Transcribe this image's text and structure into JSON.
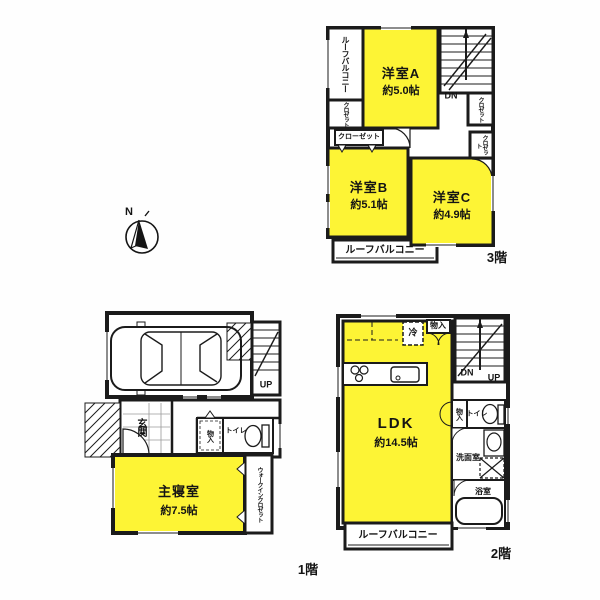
{
  "document": {
    "type": "floor-plan-scan",
    "compass_north": "N"
  },
  "colors": {
    "room_fill": "#fdf435",
    "wall": "#1b1b1b",
    "background": "#ffffff"
  },
  "floor1": {
    "label": "1階",
    "bedroom_name": "主寝室",
    "bedroom_size": "約7.5帖",
    "entrance": "玄関",
    "storage": "物入",
    "toilet": "トイレ",
    "walkin_closet": "ウォークインクロゼット",
    "up": "UP"
  },
  "floor2": {
    "label": "2階",
    "ldk_name": "LDK",
    "ldk_size": "約14.5帖",
    "fridge": "冷",
    "storage_top": "物入",
    "storage_hall": "物入",
    "toilet": "トイレ",
    "washroom": "洗面室",
    "bathroom": "浴室",
    "balcony": "ルーフバルコニー",
    "dn": "DN",
    "up": "UP"
  },
  "floor3": {
    "label": "3階",
    "room_a_name": "洋室A",
    "room_a_size": "約5.0帖",
    "room_b_name": "洋室B",
    "room_b_size": "約5.1帖",
    "room_c_name": "洋室C",
    "room_c_size": "約4.9帖",
    "balcony_top": "ルーフバルコニー",
    "balcony_bottom": "ルーフバルコニー",
    "closet_left": "クロゼット",
    "closet_shelf": "クローゼット",
    "closet_right_1": "クロゼット",
    "closet_right_2": "クロゼット",
    "dn": "DN"
  }
}
